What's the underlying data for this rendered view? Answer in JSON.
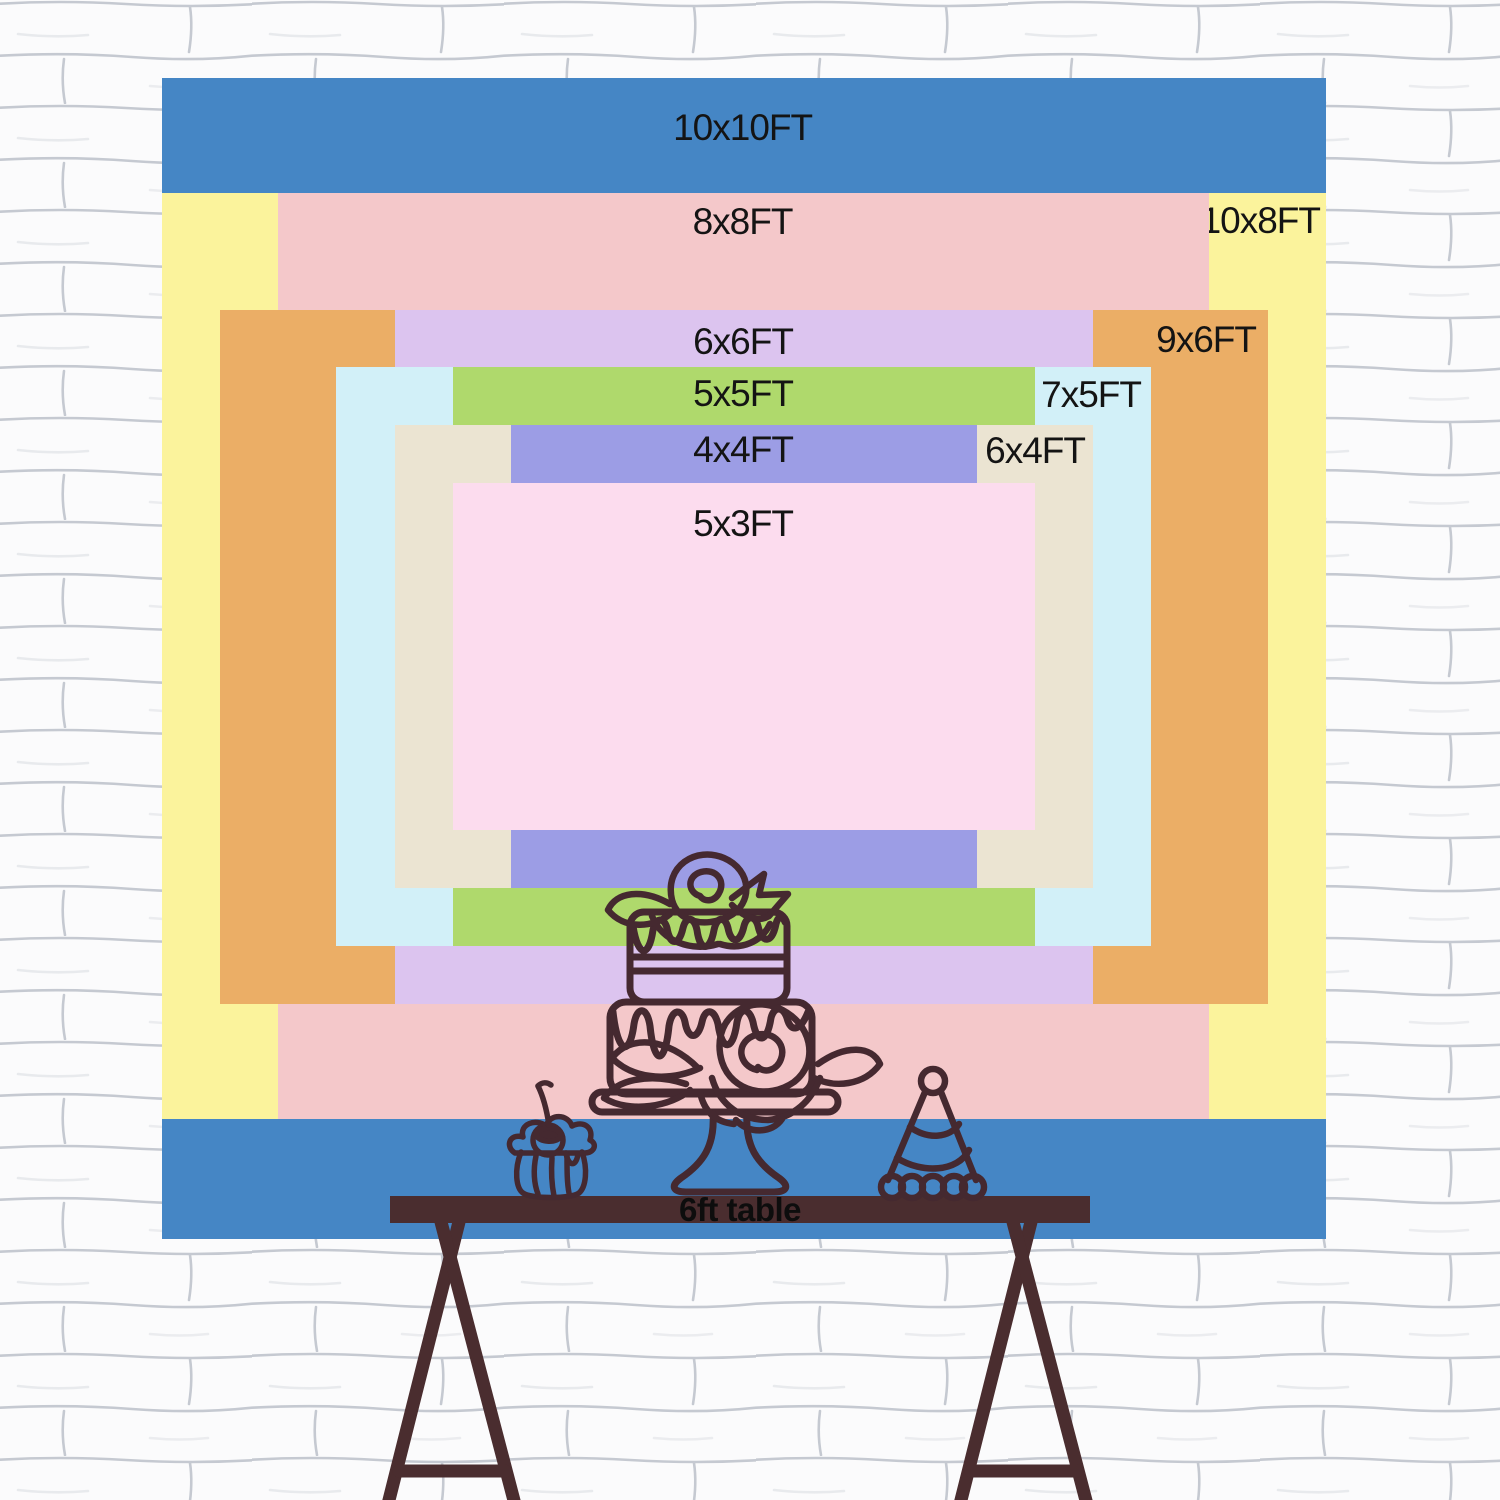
{
  "title": "Backdrop size comparison chart",
  "chart_data": {
    "type": "nested-rectangles-size-chart",
    "unit": "FT",
    "note": "All backdrop sizes drawn to scale, stacked largest to smallest, common center",
    "backdrops": [
      {
        "id": "10x10",
        "label": "10x10FT",
        "width_ft": 10,
        "height_ft": 10,
        "color": "#4586C5",
        "label_position": "top-center"
      },
      {
        "id": "10x8",
        "label": "10x8FT",
        "width_ft": 10,
        "height_ft": 8,
        "color": "#FBF39C",
        "label_position": "top-right"
      },
      {
        "id": "8x8",
        "label": "8x8FT",
        "width_ft": 8,
        "height_ft": 8,
        "color": "#F4C8CA",
        "label_position": "top-center"
      },
      {
        "id": "9x6",
        "label": "9x6FT",
        "width_ft": 9,
        "height_ft": 6,
        "color": "#EBAE66",
        "label_position": "top-right"
      },
      {
        "id": "6x6",
        "label": "6x6FT",
        "width_ft": 6,
        "height_ft": 6,
        "color": "#DCC4EF",
        "label_position": "top-center"
      },
      {
        "id": "7x5",
        "label": "7x5FT",
        "width_ft": 7,
        "height_ft": 5,
        "color": "#D2F0F8",
        "label_position": "top-right"
      },
      {
        "id": "5x5",
        "label": "5x5FT",
        "width_ft": 5,
        "height_ft": 5,
        "color": "#AFD96C",
        "label_position": "top-center"
      },
      {
        "id": "6x4",
        "label": "6x4FT",
        "width_ft": 6,
        "height_ft": 4,
        "color": "#EBE4D2",
        "label_position": "top-right"
      },
      {
        "id": "4x4",
        "label": "4x4FT",
        "width_ft": 4,
        "height_ft": 4,
        "color": "#9C9DE5",
        "label_position": "top-center"
      },
      {
        "id": "5x3",
        "label": "5x3FT",
        "width_ft": 5,
        "height_ft": 3,
        "color": "#FCDCEE",
        "label_position": "top-center"
      }
    ]
  },
  "table": {
    "label": "6ft table",
    "color": "#4A2D2F"
  },
  "illustration": {
    "line_color": "#452930",
    "items": [
      "tiered-cake-on-stand",
      "cupcake-with-cherry",
      "party-hat"
    ]
  },
  "wall": {
    "fill": "#FBFBFC",
    "mortar_line_color": "#98A0AC"
  },
  "text_color": "#141414"
}
